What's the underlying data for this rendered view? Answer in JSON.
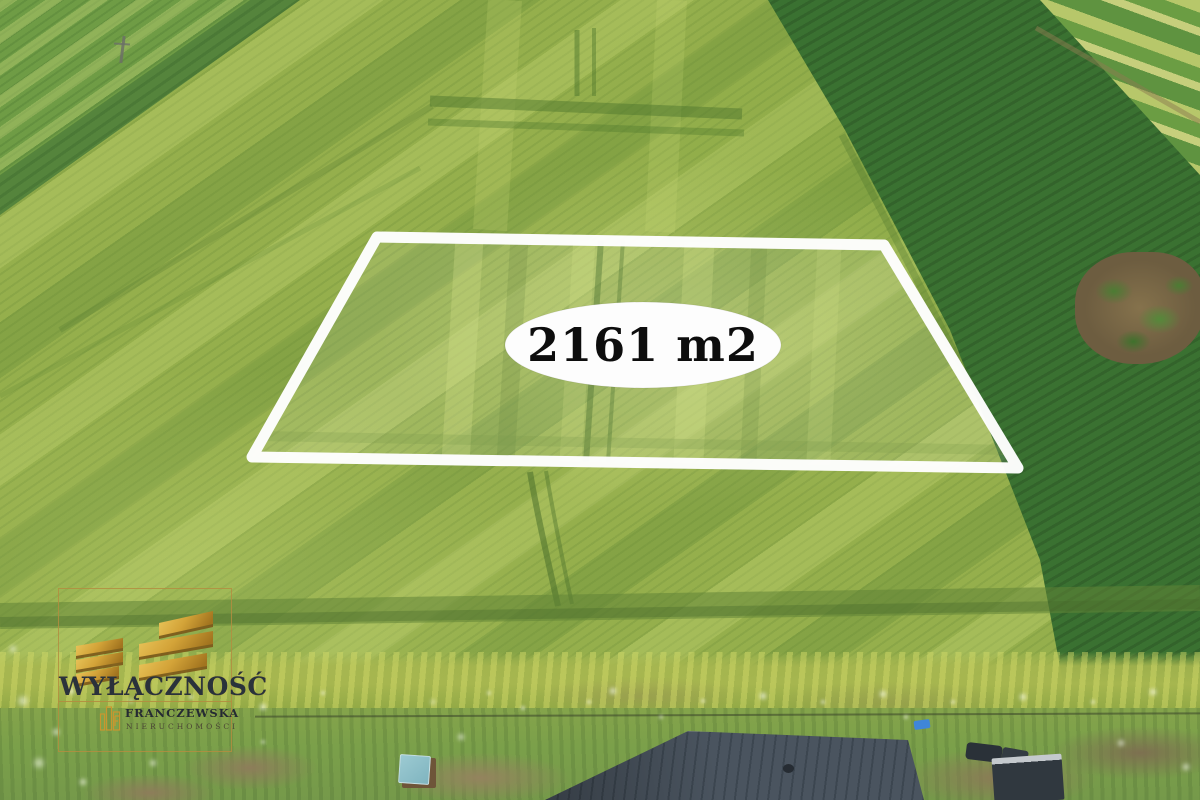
{
  "photo": {
    "parcel": {
      "area_label": "2161 m2"
    },
    "watermark": {
      "exclusivity_label": "WYŁĄCZNOŚĆ",
      "agency_name": "FRANCZEWSKA",
      "agency_type": "NIERUCHOMOŚCI"
    },
    "colors": {
      "parcel_outline": "#ffffff",
      "oval_fill": "#fdfdfd",
      "area_text": "#0d0d0d",
      "watermark_gold": "#c9962f",
      "roof": "#46515c"
    }
  }
}
